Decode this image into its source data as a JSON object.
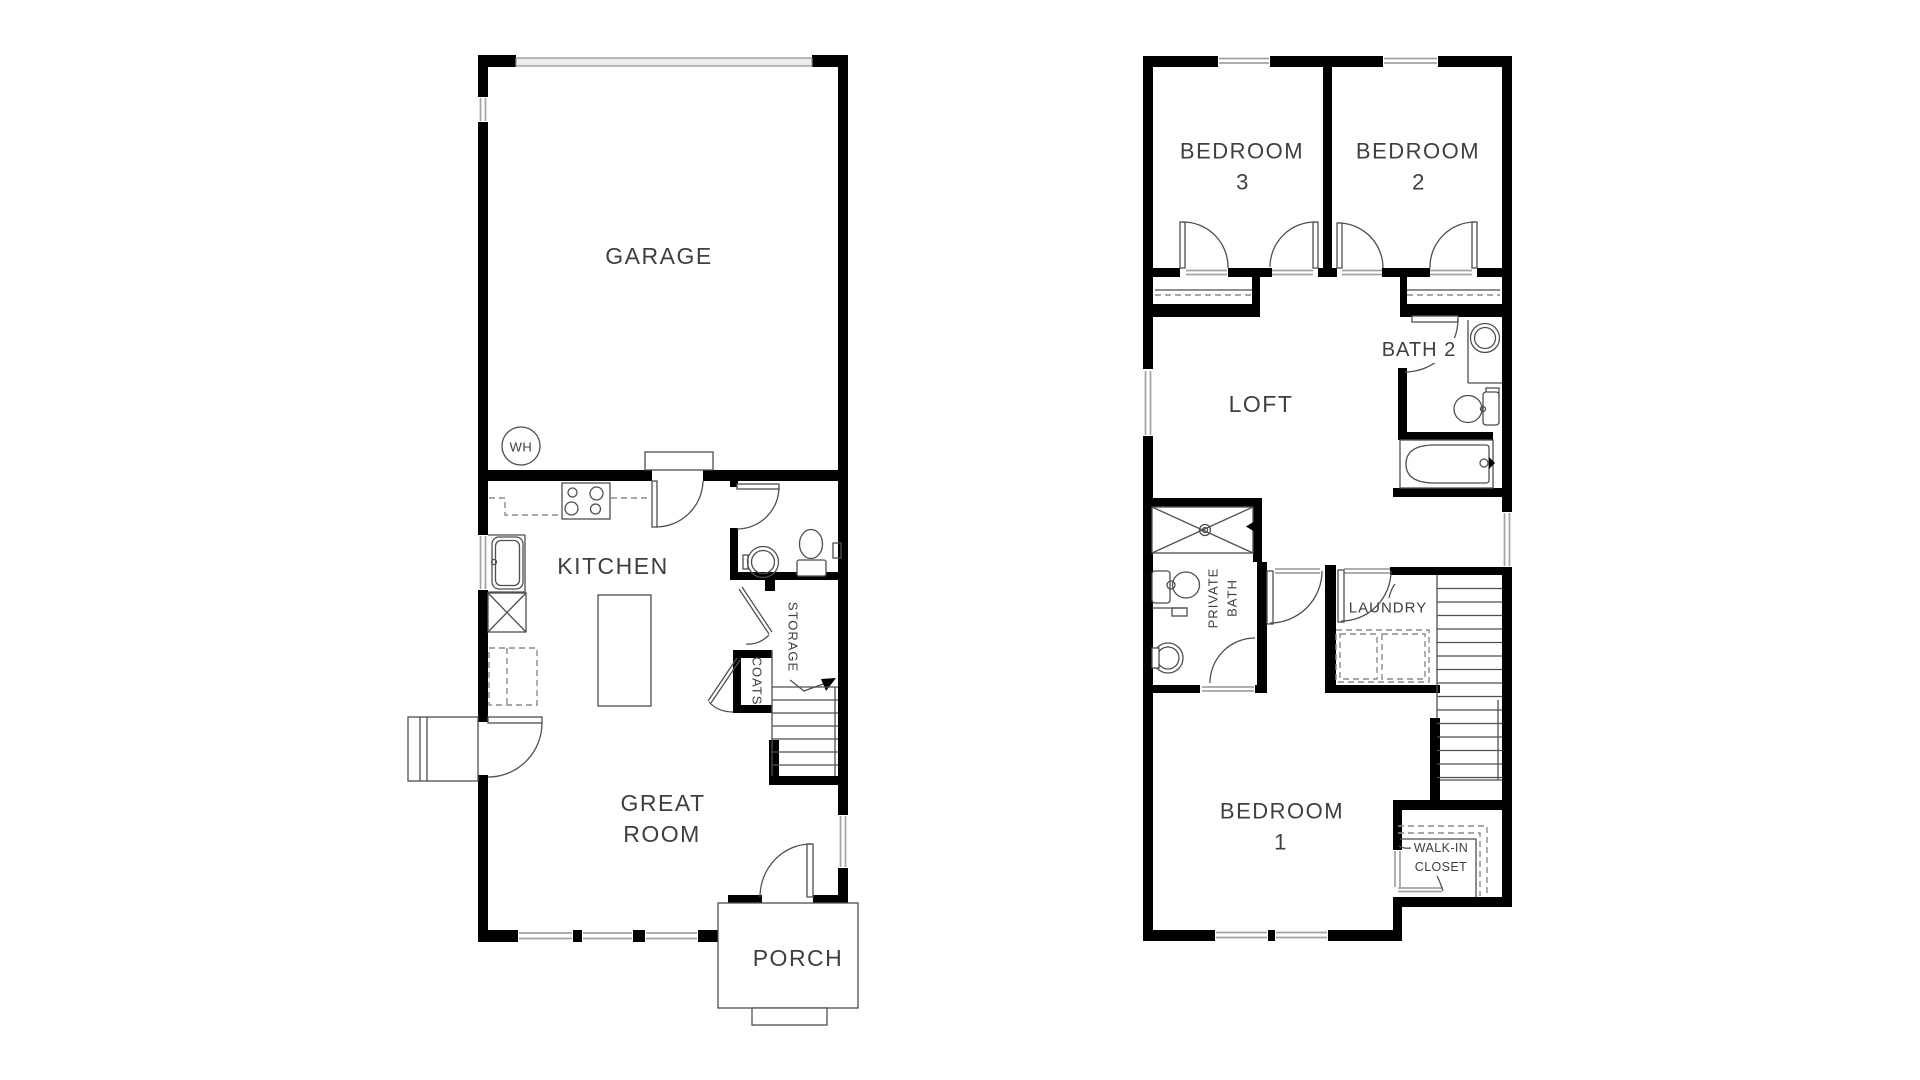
{
  "colors": {
    "wall": "#000000",
    "line": "#4f4f4f",
    "muted": "#8c8c8c",
    "window": "#a3a3a3",
    "text": "#3f3f3f",
    "bg": "#ffffff"
  },
  "first_floor": {
    "labels": {
      "garage": "GARAGE",
      "water_heater": "WH",
      "kitchen": "KITCHEN",
      "great_room": [
        "GREAT",
        "ROOM"
      ],
      "storage": "STORAGE",
      "coats": "COATS",
      "porch": "PORCH"
    }
  },
  "second_floor": {
    "labels": {
      "bedroom3": [
        "BEDROOM",
        "3"
      ],
      "bedroom2": [
        "BEDROOM",
        "2"
      ],
      "bath2": "BATH 2",
      "loft": "LOFT",
      "private_bath": [
        "PRIVATE",
        "BATH"
      ],
      "laundry": "LAUNDRY",
      "bedroom1": [
        "BEDROOM",
        "1"
      ],
      "walk_in_closet": [
        "WALK-IN",
        "CLOSET"
      ]
    }
  }
}
